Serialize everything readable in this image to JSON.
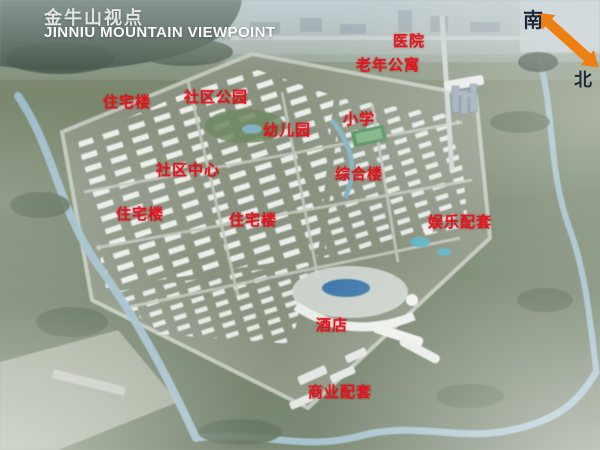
{
  "title": {
    "zh": "金牛山视点",
    "en": "JINNIU MOUNTAIN VIEWPOINT"
  },
  "compass": {
    "south": "南",
    "north": "北"
  },
  "labels": [
    {
      "id": "label-residential-nw",
      "text": "住宅楼",
      "x": 103,
      "y": 91
    },
    {
      "id": "label-community-park",
      "text": "社区公园",
      "x": 184,
      "y": 86
    },
    {
      "id": "label-hospital",
      "text": "医院",
      "x": 393,
      "y": 30
    },
    {
      "id": "label-senior-apartments",
      "text": "老年公寓",
      "x": 356,
      "y": 54
    },
    {
      "id": "label-kindergarten",
      "text": "幼儿园",
      "x": 263,
      "y": 119
    },
    {
      "id": "label-primary-school",
      "text": "小学",
      "x": 343,
      "y": 108
    },
    {
      "id": "label-community-center",
      "text": "社区中心",
      "x": 156,
      "y": 159
    },
    {
      "id": "label-complex-building",
      "text": "综合楼",
      "x": 335,
      "y": 163
    },
    {
      "id": "label-residential-w",
      "text": "住宅楼",
      "x": 116,
      "y": 203
    },
    {
      "id": "label-residential-c",
      "text": "住宅楼",
      "x": 229,
      "y": 209
    },
    {
      "id": "label-entertainment-amenities",
      "text": "娱乐配套",
      "x": 428,
      "y": 211
    },
    {
      "id": "label-hotel",
      "text": "酒店",
      "x": 316,
      "y": 314
    },
    {
      "id": "label-commercial-amenities",
      "text": "商业配套",
      "x": 308,
      "y": 381
    }
  ],
  "colors": {
    "label_red": "#e3151f",
    "compass_orange": "#ef7f12",
    "title_white": "#ffffff"
  }
}
